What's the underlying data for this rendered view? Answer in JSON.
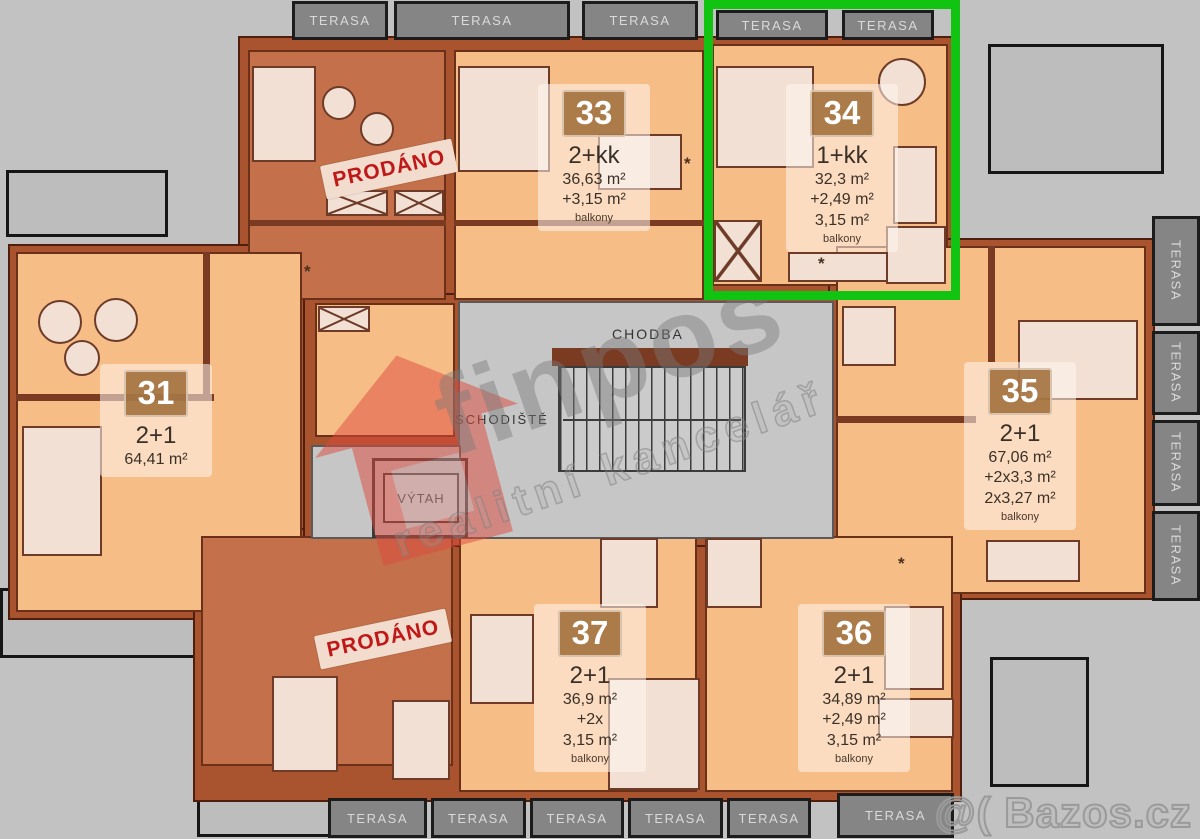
{
  "labels": {
    "terrace": "TERASA",
    "sold": "PRODÁNO",
    "corridor": "CHODBA",
    "staircase": "SCHODIŠTĚ",
    "elevator": "VÝTAH",
    "kitchen_symbol": "*"
  },
  "units": {
    "u31": {
      "number": "31",
      "layout": "2+1",
      "area1": "64,41 m²",
      "area2": "",
      "area3": "",
      "note": ""
    },
    "u33": {
      "number": "33",
      "layout": "2+kk",
      "area1": "36,63 m²",
      "area2": "+3,15 m²",
      "area3": "",
      "note": "balkony"
    },
    "u34": {
      "number": "34",
      "layout": "1+kk",
      "area1": "32,3 m²",
      "area2": "+2,49 m²",
      "area3": "3,15 m²",
      "note": "balkony"
    },
    "u35": {
      "number": "35",
      "layout": "2+1",
      "area1": "67,06 m²",
      "area2": "+2x3,3 m²",
      "area3": "2x3,27 m²",
      "note": "balkony"
    },
    "u36": {
      "number": "36",
      "layout": "2+1",
      "area1": "34,89 m²",
      "area2": "+2,49 m²",
      "area3": "3,15 m²",
      "note": "balkony"
    },
    "u37": {
      "number": "37",
      "layout": "2+1",
      "area1": "36,9 m²",
      "area2": "+2x",
      "area3": "3,15 m²",
      "note": "balkony"
    }
  },
  "watermark": {
    "brand": "finpos",
    "tagline": "realitní kancelář",
    "site": "@( Bazos.cz"
  },
  "colors": {
    "highlight_green": "#12c412",
    "apartment_floor": "#f6bd87",
    "sold_floor": "#c4714b",
    "wall": "#a9532f",
    "terrace_gray": "#858585",
    "stamp_red": "#c01818"
  }
}
